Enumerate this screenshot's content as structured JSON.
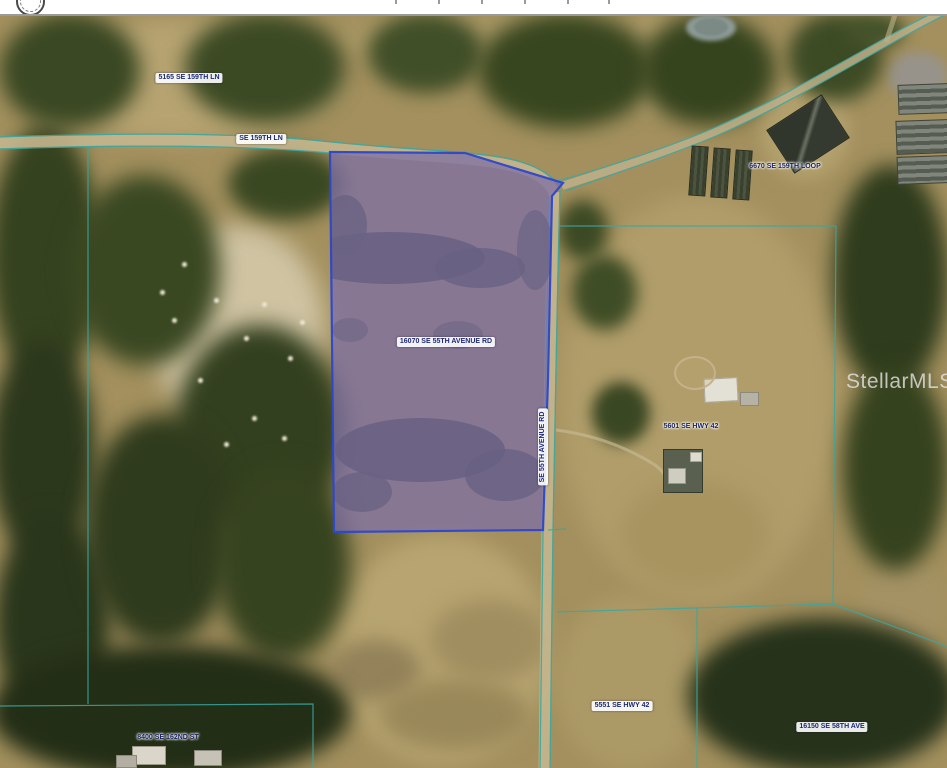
{
  "map": {
    "watermark": "StellarMLS",
    "labels": {
      "parcel_5165": "5165 SE 159TH LN",
      "road_se_159th_ln": "SE 159TH LN",
      "parcel_6670": "6670 SE 159TH LOOP",
      "subject_parcel": "16070 SE 55TH AVENUE RD",
      "road_se_55th_avenue_rd": "SE 55TH AVENUE RD",
      "parcel_5601": "5601 SE HWY 42",
      "parcel_5551": "5551 SE HWY 42",
      "parcel_16150": "16150 SE 58TH AVE",
      "parcel_8400": "8400 SE 162ND ST"
    },
    "colors": {
      "subject_parcel_fill": "#7E6FA5",
      "subject_parcel_stroke": "#2C47CC",
      "boundary_line": "#3AA7A2",
      "road_surface": "#C4B68E",
      "label_text": "#1B2A75",
      "label_background": "#FFFFFF",
      "watermark_text": "#E4E4E4"
    }
  }
}
